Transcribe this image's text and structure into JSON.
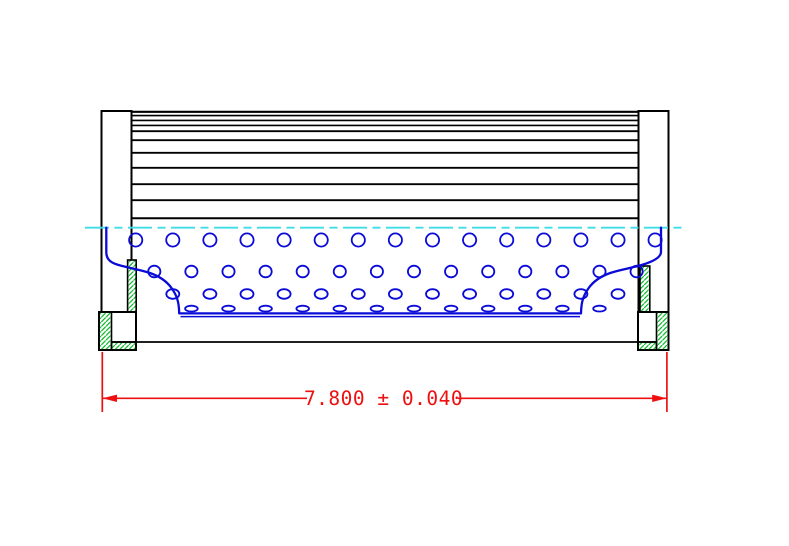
{
  "drawing": {
    "dimension": {
      "label": "7.800 ± 0.040",
      "nominal": "7.800",
      "tolerance": "0.040",
      "plus_minus_symbol": "±"
    },
    "colors": {
      "outline": "#000000",
      "perforation": "#0b0bd8",
      "centerline": "#3fdde6",
      "hatch": "#00b41e",
      "dimension": "#ee1010",
      "background": "#ffffff"
    },
    "pleats": {
      "x1": 131.5,
      "x2": 638.5,
      "lines": [
        {
          "y": 111.8,
          "w": 2.2
        },
        {
          "y": 115.6,
          "w": 1.6
        },
        {
          "y": 120.4,
          "w": 1.6
        },
        {
          "y": 125.4,
          "w": 1.6
        },
        {
          "y": 131.2,
          "w": 1.8
        },
        {
          "y": 140.2,
          "w": 1.8
        },
        {
          "y": 152.8,
          "w": 1.8
        },
        {
          "y": 167.8,
          "w": 1.8
        },
        {
          "y": 184.2,
          "w": 1.8
        },
        {
          "y": 200.2,
          "w": 1.8
        },
        {
          "y": 218.2,
          "w": 2.0
        }
      ]
    },
    "perforations": {
      "rows": [
        {
          "y": 240.0,
          "x0": 135.7,
          "step": 37.1,
          "count": 15,
          "rx": 6.6,
          "ry": 6.6
        },
        {
          "y": 271.5,
          "x0": 154.3,
          "step": 37.1,
          "count": 14,
          "rx": 6.1,
          "ry": 5.8
        },
        {
          "y": 294.0,
          "x0": 172.8,
          "step": 37.1,
          "count": 13,
          "rx": 6.5,
          "ry": 4.8
        },
        {
          "y": 308.6,
          "x0": 191.4,
          "step": 37.1,
          "count": 12,
          "rx": 6.3,
          "ry": 2.9
        }
      ]
    }
  }
}
